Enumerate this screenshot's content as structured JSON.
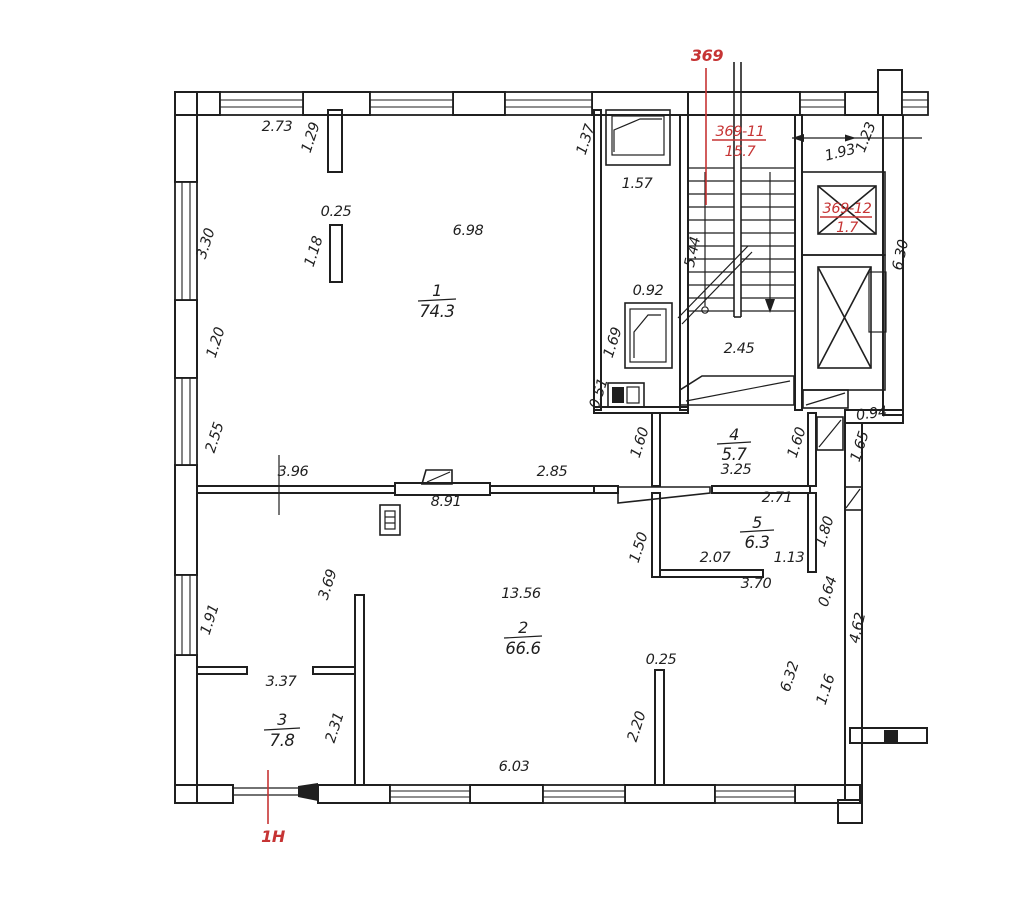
{
  "colors": {
    "ink": "#1f1f1f",
    "red": "#c63434",
    "paper": "#ffffff"
  },
  "plan": {
    "units": {
      "unit_369": {
        "text": "369"
      },
      "unit_369_11": {
        "number": "369-11",
        "area": "15.7"
      },
      "unit_369_12": {
        "number": "369-12",
        "area": "1.7"
      },
      "unit_1h": {
        "text": "1H"
      }
    },
    "rooms": [
      {
        "number": "1",
        "area": "74.3"
      },
      {
        "number": "2",
        "area": "66.6"
      },
      {
        "number": "3",
        "area": "7.8"
      },
      {
        "number": "4",
        "area": "5.7"
      },
      {
        "number": "5",
        "area": "6.3"
      }
    ],
    "dimensions": [
      {
        "t": "2.73",
        "x": 277,
        "y": 131,
        "r": 0
      },
      {
        "t": "1.29",
        "x": 315,
        "y": 139,
        "r": -72
      },
      {
        "t": "0.25",
        "x": 336,
        "y": 216,
        "r": 0
      },
      {
        "t": "1.18",
        "x": 318,
        "y": 253,
        "r": -72
      },
      {
        "t": "6.98",
        "x": 468,
        "y": 235,
        "r": 0
      },
      {
        "t": "1.37",
        "x": 590,
        "y": 141,
        "r": -72
      },
      {
        "t": "1.57",
        "x": 637,
        "y": 188,
        "r": 0
      },
      {
        "t": "3.30",
        "x": 210,
        "y": 245,
        "r": -72
      },
      {
        "t": "1.20",
        "x": 220,
        "y": 344,
        "r": -72
      },
      {
        "t": "2.55",
        "x": 219,
        "y": 439,
        "r": -72
      },
      {
        "t": "1.91",
        "x": 214,
        "y": 621,
        "r": -72
      },
      {
        "t": "0.92",
        "x": 648,
        "y": 295,
        "r": 0
      },
      {
        "t": "1.69",
        "x": 617,
        "y": 344,
        "r": -72
      },
      {
        "t": "0.51",
        "x": 603,
        "y": 395,
        "r": -72
      },
      {
        "t": "5.44",
        "x": 697,
        "y": 253,
        "r": -78
      },
      {
        "t": "2.45",
        "x": 739,
        "y": 353,
        "r": 0
      },
      {
        "t": "6.30",
        "x": 905,
        "y": 256,
        "r": -78
      },
      {
        "t": "0.94",
        "x": 872,
        "y": 418,
        "r": -8
      },
      {
        "t": "1.65",
        "x": 864,
        "y": 448,
        "r": -72
      },
      {
        "t": "1.60",
        "x": 644,
        "y": 444,
        "r": -72
      },
      {
        "t": "1.60",
        "x": 801,
        "y": 444,
        "r": -72
      },
      {
        "t": "3.25",
        "x": 736,
        "y": 474,
        "r": 0
      },
      {
        "t": "3.96",
        "x": 293,
        "y": 476,
        "r": 0
      },
      {
        "t": "2.85",
        "x": 552,
        "y": 476,
        "r": 0
      },
      {
        "t": "8.91",
        "x": 446,
        "y": 506,
        "r": 0
      },
      {
        "t": "2.71",
        "x": 777,
        "y": 502,
        "r": 0
      },
      {
        "t": "1.80",
        "x": 829,
        "y": 533,
        "r": -72
      },
      {
        "t": "1.50",
        "x": 643,
        "y": 549,
        "r": -72
      },
      {
        "t": "2.07",
        "x": 715,
        "y": 562,
        "r": 0
      },
      {
        "t": "1.13",
        "x": 789,
        "y": 562,
        "r": 0
      },
      {
        "t": "3.70",
        "x": 756,
        "y": 588,
        "r": 0
      },
      {
        "t": "0.64",
        "x": 832,
        "y": 593,
        "r": -72
      },
      {
        "t": "4.62",
        "x": 862,
        "y": 629,
        "r": -78
      },
      {
        "t": "3.69",
        "x": 332,
        "y": 586,
        "r": -72
      },
      {
        "t": "13.56",
        "x": 521,
        "y": 598,
        "r": 0
      },
      {
        "t": "6.32",
        "x": 794,
        "y": 678,
        "r": -72
      },
      {
        "t": "1.16",
        "x": 830,
        "y": 691,
        "r": -72
      },
      {
        "t": "0.25",
        "x": 661,
        "y": 664,
        "r": 0
      },
      {
        "t": "2.20",
        "x": 641,
        "y": 728,
        "r": -72
      },
      {
        "t": "3.37",
        "x": 281,
        "y": 686,
        "r": 0
      },
      {
        "t": "2.31",
        "x": 339,
        "y": 729,
        "r": -72
      },
      {
        "t": "6.03",
        "x": 514,
        "y": 771,
        "r": 0
      },
      {
        "t": "1.93",
        "x": 841,
        "y": 157,
        "r": -14
      },
      {
        "t": "1.23",
        "x": 870,
        "y": 139,
        "r": -68
      }
    ]
  }
}
